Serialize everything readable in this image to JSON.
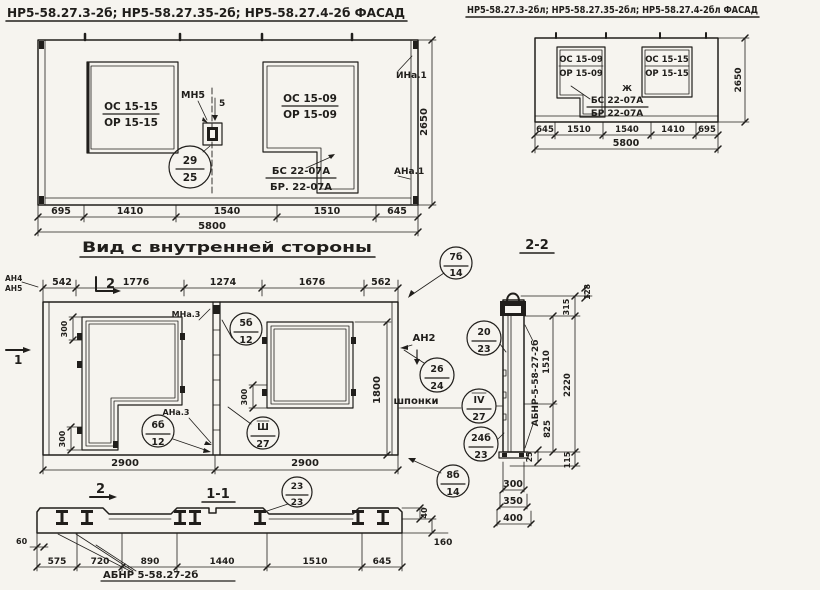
{
  "colors": {
    "paper": "#f6f4ef",
    "ink": "#201e1b"
  },
  "facade_left": {
    "title": "НР5-58.27.3-2б; НР5-58.27.35-2б; НР5-58.27.4-2б ФАСАД",
    "win_left_top": "ОС 15-15",
    "win_left_bot": "ОР 15-15",
    "win_right_top": "ОС 15-09",
    "win_right_bot": "ОР 15-09",
    "anchor_label": "МН5",
    "anchor_gap": "5",
    "callout_top": "29",
    "callout_bot": "25",
    "beam_top": "БС 22-07А",
    "beam_bot": "БР. 22-07А",
    "corner_top": "ИНа.1",
    "corner_bot": "АНа.1",
    "height": "2650",
    "total": "5800",
    "dims": [
      "695",
      "1410",
      "1540",
      "1510",
      "645"
    ]
  },
  "facade_right": {
    "title": "НР5-58.27.3-2бл; НР5-58.27.35-2бл; НР5-58.27.4-2бл ФАСАД",
    "win_left_top": "ОС 15-09",
    "win_left_bot": "ОР 15-09",
    "win_right_top": "ОС 15-15",
    "win_right_bot": "ОР 15-15",
    "mark": "Ж",
    "beam_top": "БС 22-07А",
    "beam_bot": "БР 22-07А",
    "height": "2650",
    "total": "5800",
    "dims": [
      "645",
      "1510",
      "1540",
      "1410",
      "695"
    ]
  },
  "inner_view": {
    "title": "Вид с внутренней стороны",
    "top_dims": [
      "542",
      "1776",
      "1274",
      "1676",
      "562"
    ],
    "label_an4": "АН4",
    "label_an5": "АН5",
    "section_mark_top": "2",
    "section_mark_bottom": "2",
    "section_mark_left": "1",
    "callout_7b": {
      "top": "7б",
      "bot": "14"
    },
    "label_mna3": "МНа.3",
    "label_ana3": "АНа.3",
    "callout_5b": {
      "top": "5б",
      "bot": "12"
    },
    "callout_6b": {
      "top": "6б",
      "bot": "12"
    },
    "callout_sh": {
      "top": "Ш",
      "bot": "27"
    },
    "callout_26": {
      "top": "26",
      "bot": "24"
    },
    "callout_20": {
      "top": "20",
      "bot": "23"
    },
    "callout_iv": {
      "top": "IV",
      "bot": "27"
    },
    "callout_24b": {
      "top": "24б",
      "bot": "23"
    },
    "callout_8b": {
      "top": "8б",
      "bot": "14"
    },
    "label_an2": "АН2",
    "label_shponki": "шпонки",
    "dim_300": "300",
    "dim_1800": "1800",
    "bottom_dims": [
      "2900",
      "2900"
    ]
  },
  "section_1_1": {
    "title": "1-1",
    "callout_23": {
      "top": "23",
      "bot": "23"
    },
    "dims": [
      "575",
      "720",
      "890",
      "1440",
      "1510",
      "645"
    ],
    "dim_60": "60",
    "dim_40": "40",
    "dim_160": "160",
    "label": "АБНР 5-58.27-2б"
  },
  "section_2_2": {
    "title": "2-2",
    "label_vertical": "АБНР-5-58-27-2б",
    "dim_1510": "1510",
    "dim_825": "825",
    "dim_25": "25",
    "dim_315": "315",
    "dim_2220": "2220",
    "dim_115": "115",
    "dim_128": "128",
    "widths": [
      "300",
      "350",
      "400"
    ]
  }
}
